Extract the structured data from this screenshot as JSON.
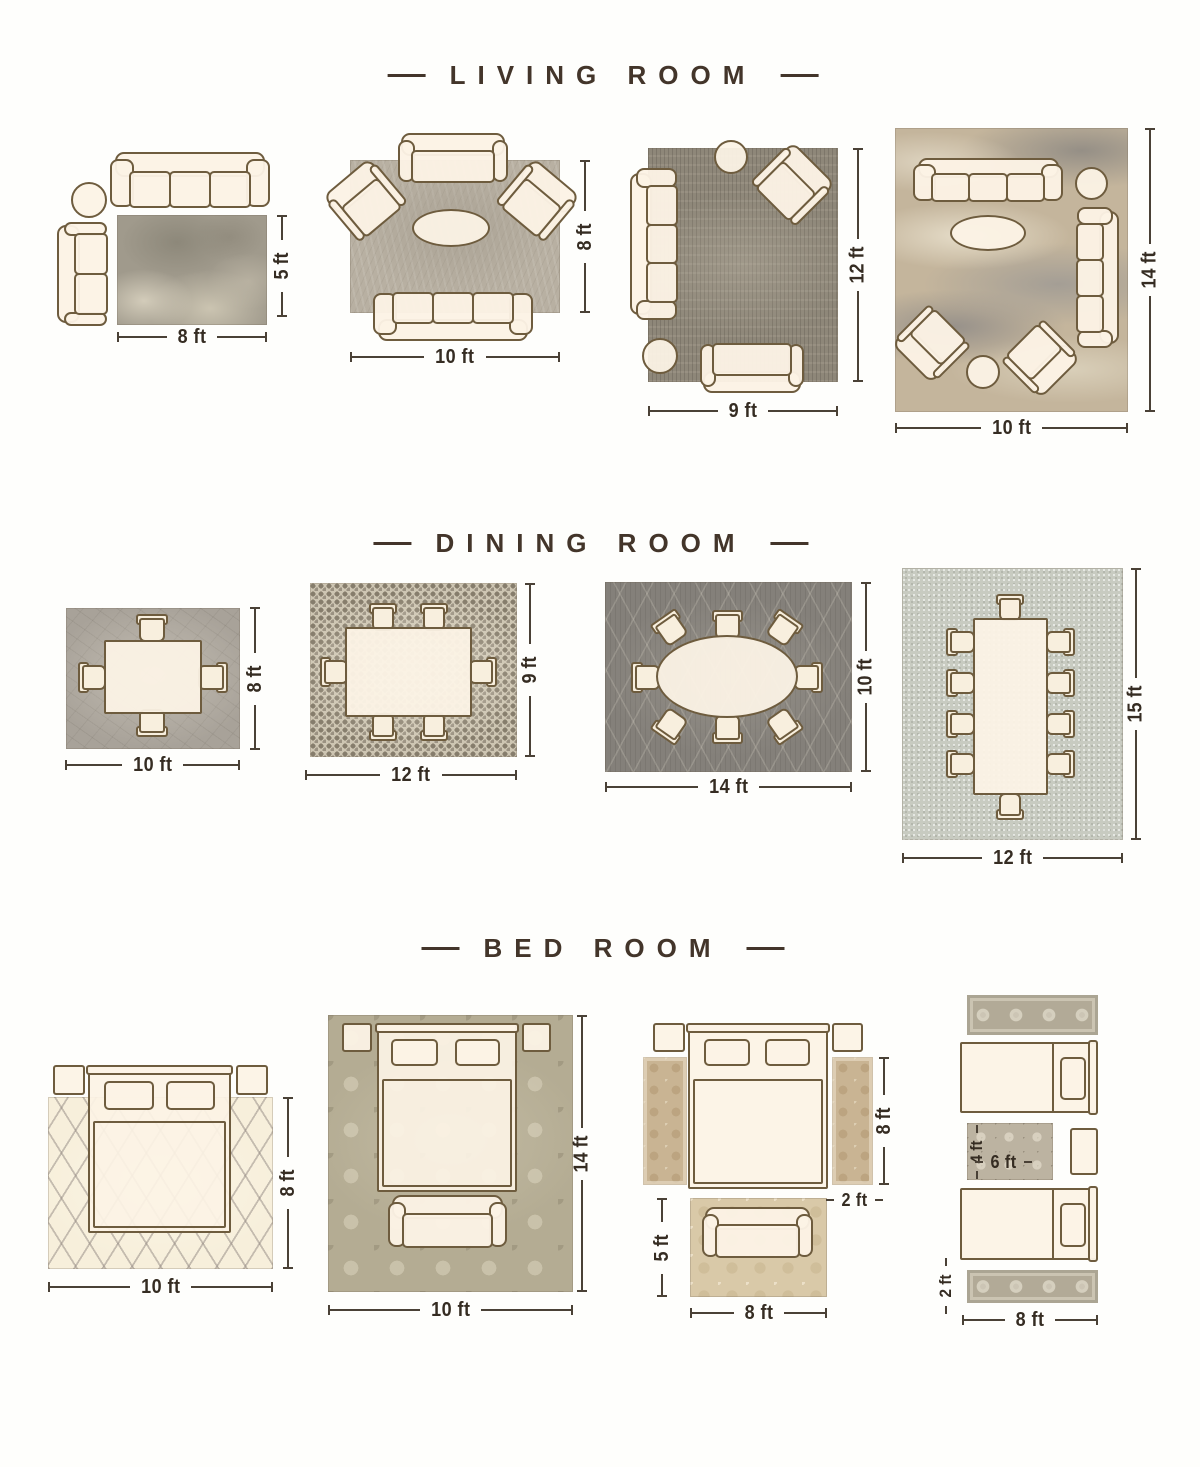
{
  "colors": {
    "title": "#43352a",
    "dimension_text": "#352c22",
    "furniture_outline": "#6e5c3e",
    "furniture_fill": "#fbf2e3"
  },
  "sections": [
    {
      "title": "LIVING ROOM",
      "layouts": [
        {
          "width": "8 ft",
          "height": "5 ft"
        },
        {
          "width": "10 ft",
          "height": "8 ft"
        },
        {
          "width": "9 ft",
          "height": "12 ft"
        },
        {
          "width": "10 ft",
          "height": "14 ft"
        }
      ]
    },
    {
      "title": "DINING ROOM",
      "layouts": [
        {
          "width": "10 ft",
          "height": "8 ft"
        },
        {
          "width": "12 ft",
          "height": "9 ft"
        },
        {
          "width": "14 ft",
          "height": "10 ft"
        },
        {
          "width": "12 ft",
          "height": "15 ft"
        }
      ]
    },
    {
      "title": "BED ROOM",
      "layouts": [
        {
          "width": "10 ft",
          "height": "8 ft"
        },
        {
          "width": "10 ft",
          "height": "14 ft"
        },
        {
          "width": "8 ft",
          "height": "5 ft",
          "runner_height": "8 ft",
          "runner_width": "2 ft"
        },
        {
          "width": "8 ft",
          "runner_width": "2 ft",
          "accent_width": "6 ft",
          "accent_height": "4 ft"
        }
      ]
    }
  ]
}
